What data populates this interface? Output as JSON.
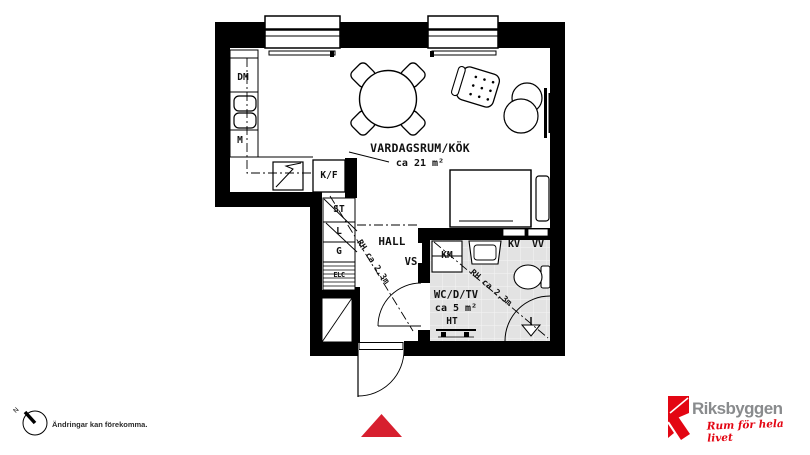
{
  "plan": {
    "rooms": {
      "living": {
        "name": "VARDAGSRUM/KÖK",
        "area": "ca 21 m²"
      },
      "hall": {
        "name": "HALL"
      },
      "bathroom": {
        "name": "WC/D/TV",
        "area": "ca 5 m²"
      }
    },
    "fixtures": {
      "dm": "DM",
      "m": "M",
      "kf": "K/F",
      "st": "ST",
      "l": "L",
      "g": "G",
      "elc": "ELC",
      "vs": "VS",
      "km": "KM",
      "kv": "KV",
      "vv": "VV",
      "ht": "HT"
    },
    "measurements": {
      "hall_rh": "RH ca 2,3m",
      "bathroom_rh": "RH ca 2,3m"
    },
    "compass": {
      "north_label": "N"
    },
    "disclaimer": "Ändringar kan förekomma."
  },
  "branding": {
    "logo_text": "Riksbyggen",
    "tagline": "Rum för hela livet"
  },
  "colors": {
    "wall": "#000000",
    "bathroom_floor": "#e3e3e3",
    "entrance_marker": "#d71f2f",
    "logo_red": "#e30613",
    "logo_gray": "#898b8d"
  }
}
